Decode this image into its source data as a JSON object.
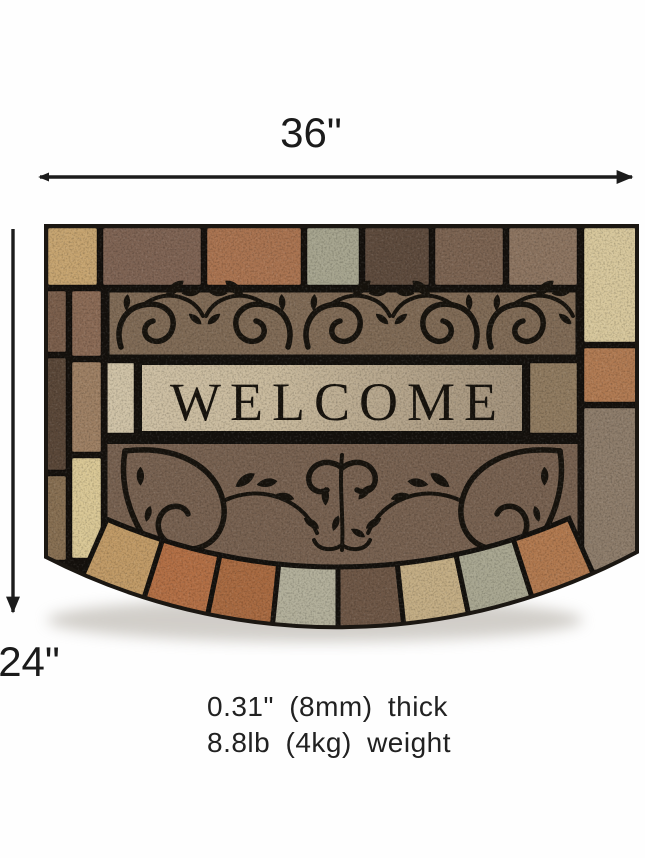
{
  "dimensions": {
    "width_label": "36\"",
    "height_label": "24\"",
    "thickness_note": "0.31\" (8mm) thick",
    "weight_note": "8.8lb (4kg) weight",
    "arrow_color": "#1c1c1c"
  },
  "mat": {
    "welcome_text": "WELCOME",
    "palette": {
      "grout": "#15110d",
      "scroll": "#17130d",
      "band": "#7f6a55",
      "band_dark": "#776150",
      "plank_light": "#cdbfa3",
      "plank_dark": "#a2917a",
      "tan": "#c6a470",
      "cream": "#d7c79c",
      "brown": "#7e6353",
      "dark_brown": "#5e4b3d",
      "terracotta": "#ac7350",
      "sage": "#a8a58f"
    }
  }
}
